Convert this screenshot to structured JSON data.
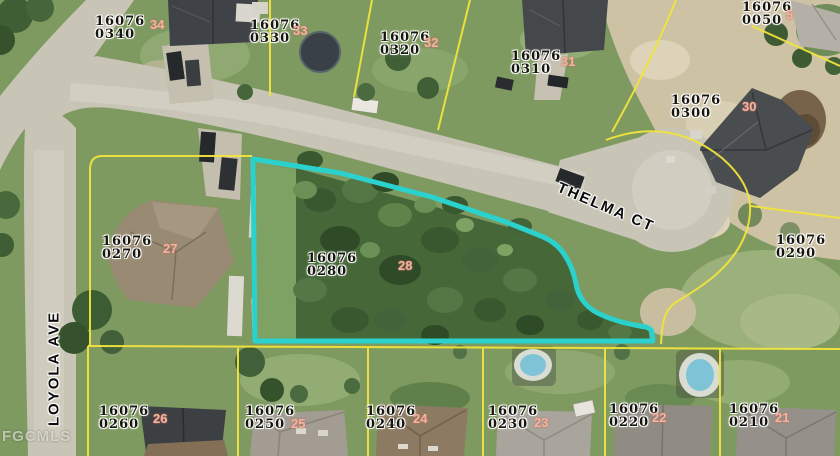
{
  "map": {
    "watermark": "FGCMLS",
    "subject_parcel": "16076 0280",
    "streets": [
      {
        "name": "THELMA CT"
      },
      {
        "name": "LOYOLA AVE"
      }
    ],
    "parcels": [
      {
        "line1": "16076",
        "line2": "0340",
        "lot": "34"
      },
      {
        "line1": "16076",
        "line2": "0330",
        "lot": "33"
      },
      {
        "line1": "16076",
        "line2": "0320",
        "lot": "32"
      },
      {
        "line1": "16076",
        "line2": "0310",
        "lot": "31"
      },
      {
        "line1": "16076",
        "line2": "0050",
        "lot": "5"
      },
      {
        "line1": "16076",
        "line2": "0300",
        "lot": "30"
      },
      {
        "line1": "16076",
        "line2": "0270",
        "lot": "27"
      },
      {
        "line1": "16076",
        "line2": "0280",
        "lot": "28"
      },
      {
        "line1": "16076",
        "line2": "0290",
        "lot": ""
      },
      {
        "line1": "16076",
        "line2": "0260",
        "lot": "26"
      },
      {
        "line1": "16076",
        "line2": "0250",
        "lot": "25"
      },
      {
        "line1": "16076",
        "line2": "0240",
        "lot": "24"
      },
      {
        "line1": "16076",
        "line2": "0230",
        "lot": "23"
      },
      {
        "line1": "16076",
        "line2": "0220",
        "lot": "22"
      },
      {
        "line1": "16076",
        "line2": "0210",
        "lot": "21"
      }
    ],
    "colors": {
      "highlight_outline": "#2bd2cd",
      "parcel_line": "#f1e43c",
      "lot_number": "#f2b4a3",
      "label_text": "#17150f"
    }
  }
}
